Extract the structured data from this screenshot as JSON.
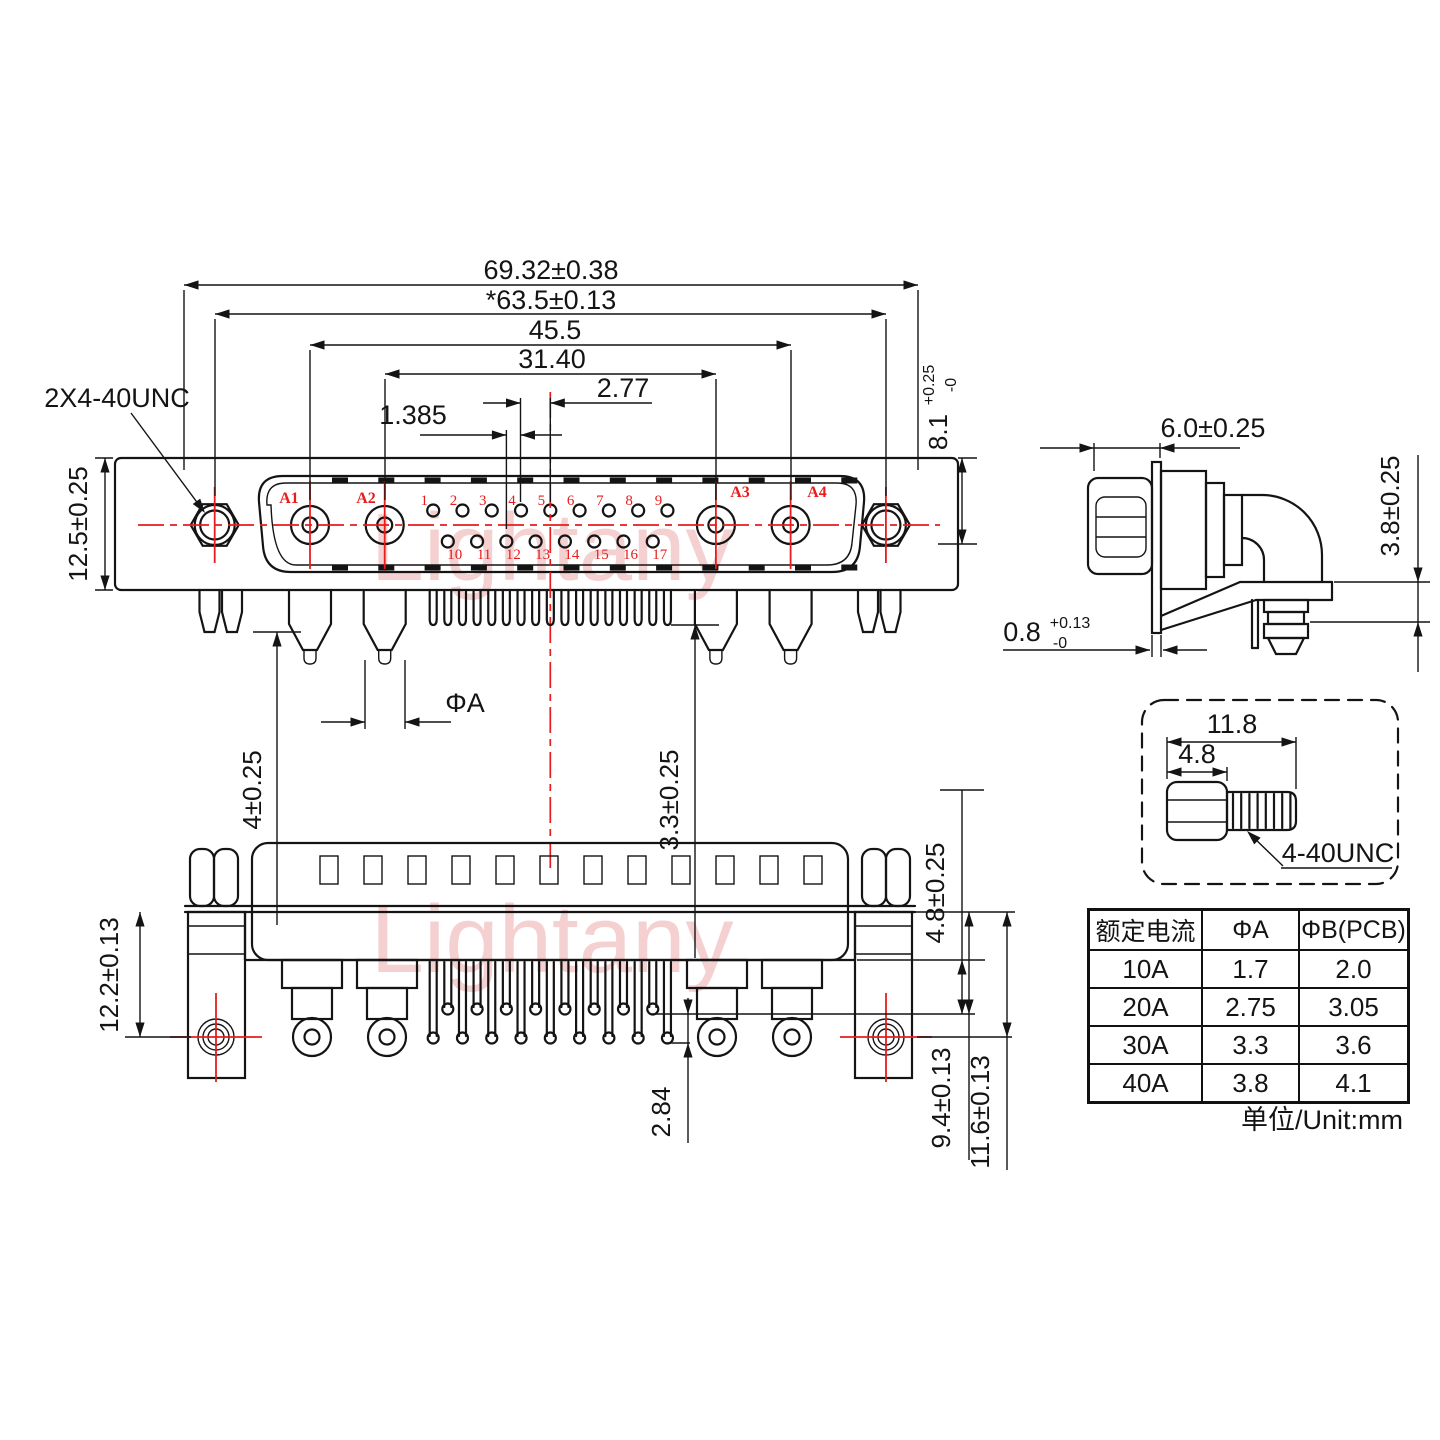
{
  "colors": {
    "line": "#141414",
    "red": "#e81c1c",
    "watermark": "#eeaaaa"
  },
  "watermark": {
    "text": "Lightany"
  },
  "front_view": {
    "thread_callout": "2X4-40UNC",
    "dim_total_width": "69.32±0.38",
    "dim_flange_width": "*63.5±0.13",
    "dim_coax_outer_span": "45.5",
    "dim_coax_inner_span": "31.40",
    "dim_pin_pitch": "2.77",
    "dim_row_offset": "1.385",
    "dim_flange_height": "12.5±0.25",
    "dim_insert_depth": "8.1",
    "dim_insert_depth_tol_plus": "+0.25",
    "dim_insert_depth_tol_minus": "-0",
    "dim_pin_dia": "ΦA",
    "dim_peg_length": "4±0.25",
    "dim_pin_length": "3.3±0.25",
    "dim_tail_length": "4.8±0.25",
    "coax_pins": [
      "A1",
      "A2",
      "A3",
      "A4"
    ],
    "pins_top": [
      "1",
      "2",
      "3",
      "4",
      "5",
      "6",
      "7",
      "8",
      "9"
    ],
    "pins_bottom": [
      "10",
      "11",
      "12",
      "13",
      "14",
      "15",
      "16",
      "17"
    ]
  },
  "side_view": {
    "dim_depth": "6.0±0.25",
    "dim_standoff": "3.8±0.25",
    "dim_plate": "0.8",
    "dim_plate_tol_plus": "+0.13",
    "dim_plate_tol_minus": "-0"
  },
  "screw_detail": {
    "dim_length": "11.8",
    "dim_head": "4.8",
    "thread_label": "4-40UNC"
  },
  "bottom_view": {
    "dim_bracket_height": "12.2±0.13",
    "dim_tip_stagger": "2.84",
    "dim_short_pin": "9.4±0.13",
    "dim_long_pin": "11.6±0.13"
  },
  "spec_table": {
    "headers": [
      "额定电流",
      "ΦA",
      "ΦB(PCB)"
    ],
    "rows": [
      [
        "10A",
        "1.7",
        "2.0"
      ],
      [
        "20A",
        "2.75",
        "3.05"
      ],
      [
        "30A",
        "3.3",
        "3.6"
      ],
      [
        "40A",
        "3.8",
        "4.1"
      ]
    ],
    "unit_note": "单位/Unit:mm"
  }
}
